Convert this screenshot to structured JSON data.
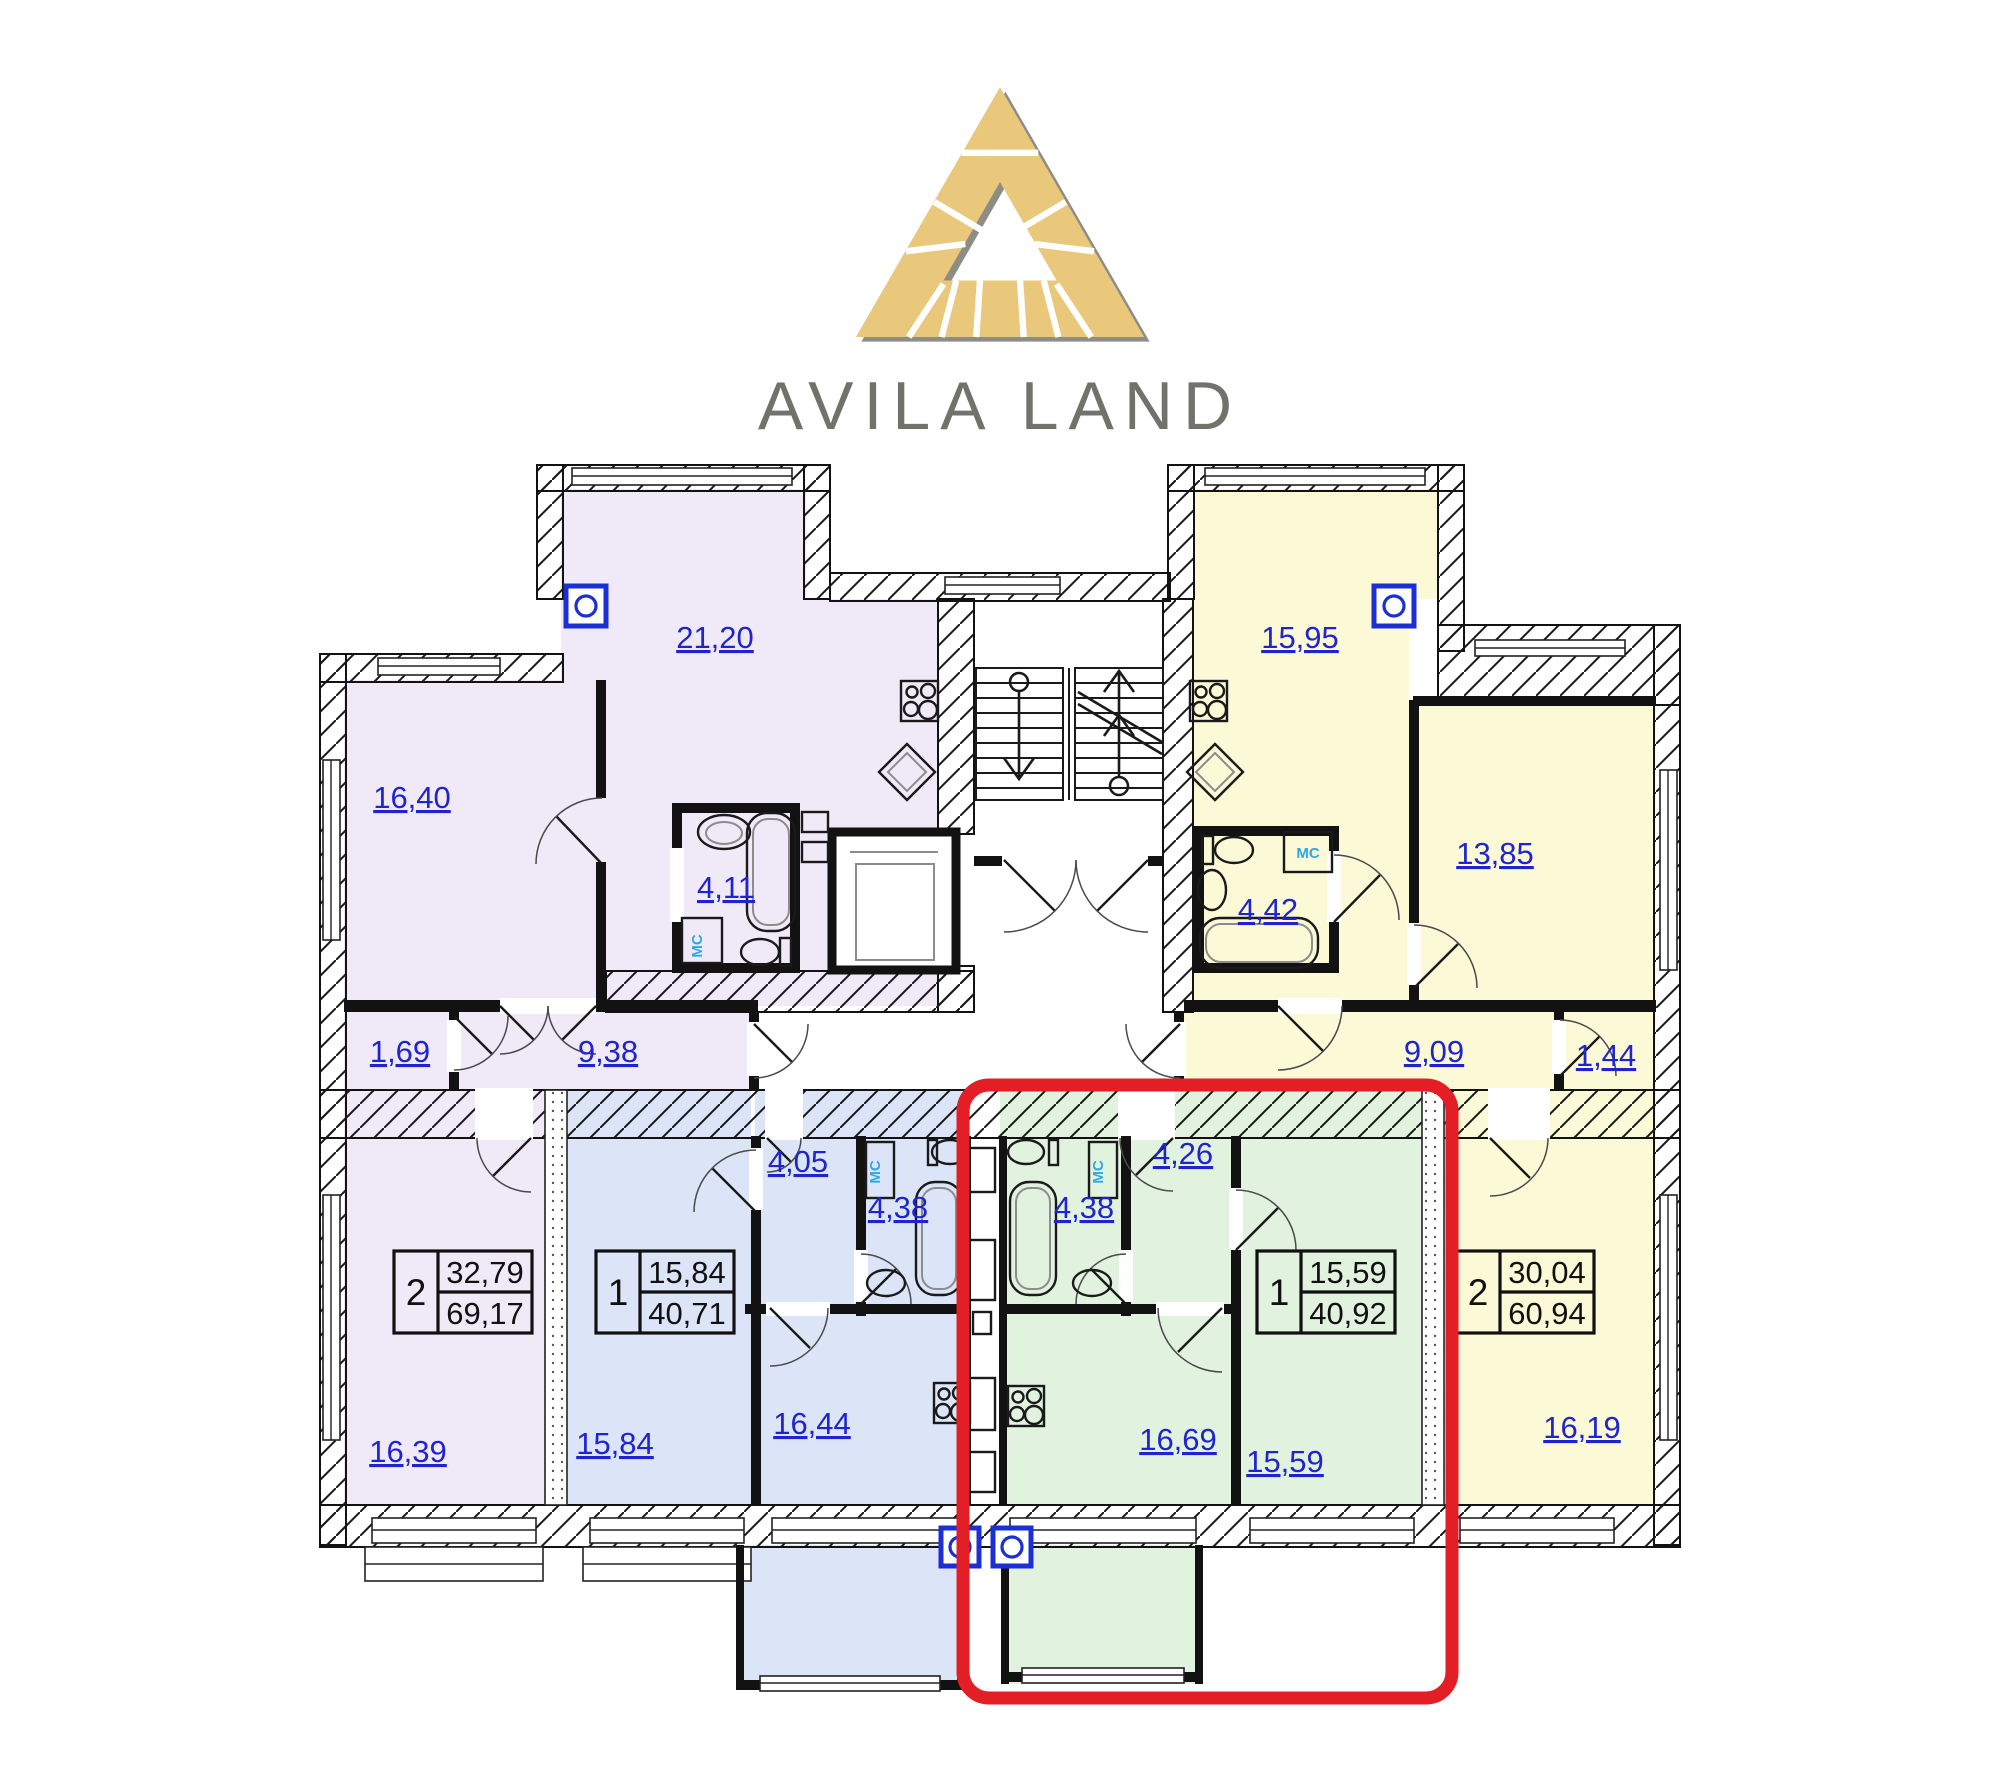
{
  "brand": {
    "name": "AVILA LAND"
  },
  "legend": {
    "washing_machine_abbr": "МС"
  },
  "highlight": {
    "color": "#e31e24"
  },
  "palette": {
    "purple_apartment": "#f0e9f8",
    "blue_apartment": "#dbe5f7",
    "green_apartment": "#e1f2df",
    "yellow_apartment": "#fbf9d6",
    "area_label_blue": "#1f24cf",
    "mc_cyan": "#2fa7e0",
    "logo_gold": "#e9c87c",
    "logo_gray": "#8d8d86"
  },
  "apartments": [
    {
      "name": "two-room-left-purple",
      "rooms_count": "2",
      "living_area": "32,79",
      "total_area": "69,17",
      "room_areas": {
        "kitchen_living": "21,20",
        "bedroom": "16,40",
        "bathroom": "4,11",
        "closet": "1,69",
        "hallway": "9,38",
        "bedroom2": "16,39"
      }
    },
    {
      "name": "one-room-blue",
      "rooms_count": "1",
      "living_area": "15,84",
      "total_area": "40,71",
      "room_areas": {
        "bedroom": "15,84",
        "hallway": "4,05",
        "bathroom": "4,38",
        "kitchen": "16,44"
      }
    },
    {
      "name": "one-room-green-highlighted",
      "rooms_count": "1",
      "living_area": "15,59",
      "total_area": "40,92",
      "room_areas": {
        "bathroom": "4,38",
        "hallway": "4,26",
        "kitchen": "16,69",
        "bedroom": "15,59"
      }
    },
    {
      "name": "two-room-right-yellow",
      "rooms_count": "2",
      "living_area": "30,04",
      "total_area": "60,94",
      "room_areas": {
        "kitchen_living": "15,95",
        "bathroom": "4,42",
        "bedroom": "13,85",
        "hallway": "9,09",
        "closet": "1,44",
        "bedroom2": "16,19"
      }
    }
  ]
}
